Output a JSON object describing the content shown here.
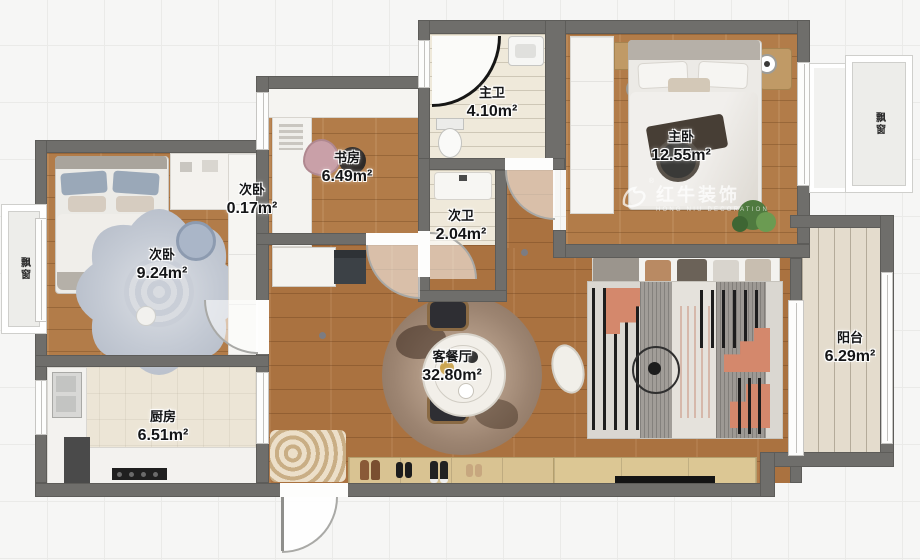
{
  "rooms": [
    {
      "id": "master-bath",
      "name": "主卫",
      "area": "4.10m²"
    },
    {
      "id": "master-bedroom",
      "name": "主卧",
      "area": "12.55m²"
    },
    {
      "id": "study",
      "name": "书房",
      "area": "6.49m²"
    },
    {
      "id": "closet",
      "name": "次卧",
      "area": "0.17m²"
    },
    {
      "id": "second-bath",
      "name": "次卫",
      "area": "2.04m²"
    },
    {
      "id": "second-bedroom",
      "name": "次卧",
      "area": "9.24m²"
    },
    {
      "id": "kitchen",
      "name": "厨房",
      "area": "6.51m²"
    },
    {
      "id": "living-dining",
      "name": "客餐厅",
      "area": "32.80m²"
    },
    {
      "id": "balcony",
      "name": "阳台",
      "area": "6.29m²"
    }
  ],
  "labels": {
    "bay_window_left": "飘窗",
    "bay_window_right": "飘窗"
  },
  "watermark": {
    "brand": "红牛装饰",
    "subtitle": "HONG NIU DECORATION",
    "registered": "®"
  },
  "colors": {
    "wall": "#6f6e6b",
    "wood_floor": "#b27c49",
    "tile_floor": "#efe9da",
    "rug_salmon": "#d4886c",
    "watermark_white": "#ffffff"
  }
}
